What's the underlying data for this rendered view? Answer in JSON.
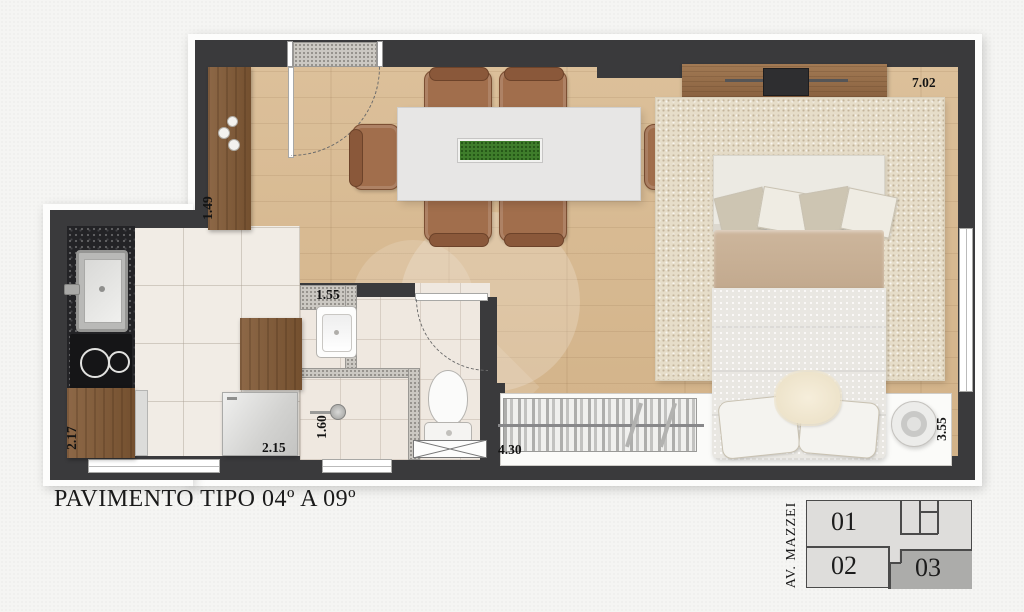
{
  "title": "PAVIMENTO TIPO 04º A 09º",
  "dimensions": {
    "living_top": "7.02",
    "entry_cabinet": "1.49",
    "bath_width": "1.55",
    "shower_width": "1.60",
    "kitchen_depth": "2.17",
    "kitchen_width": "2.15",
    "balcony_door": "4.30",
    "bedroom_depth": "3.55"
  },
  "key_plan": {
    "street": "AV. MAZZEI",
    "units": [
      {
        "label": "01",
        "highlighted": false
      },
      {
        "label": "02",
        "highlighted": false
      },
      {
        "label": "03",
        "highlighted": true
      }
    ]
  },
  "colors": {
    "wall": "#3a3a3c",
    "wood_floor": "#d7b890",
    "tile_floor": "#f0ebe4",
    "rug": "#e6ddc9",
    "granite": "#232326",
    "unit_highlight": "#acacaa",
    "plant": "#3e7d2b"
  }
}
